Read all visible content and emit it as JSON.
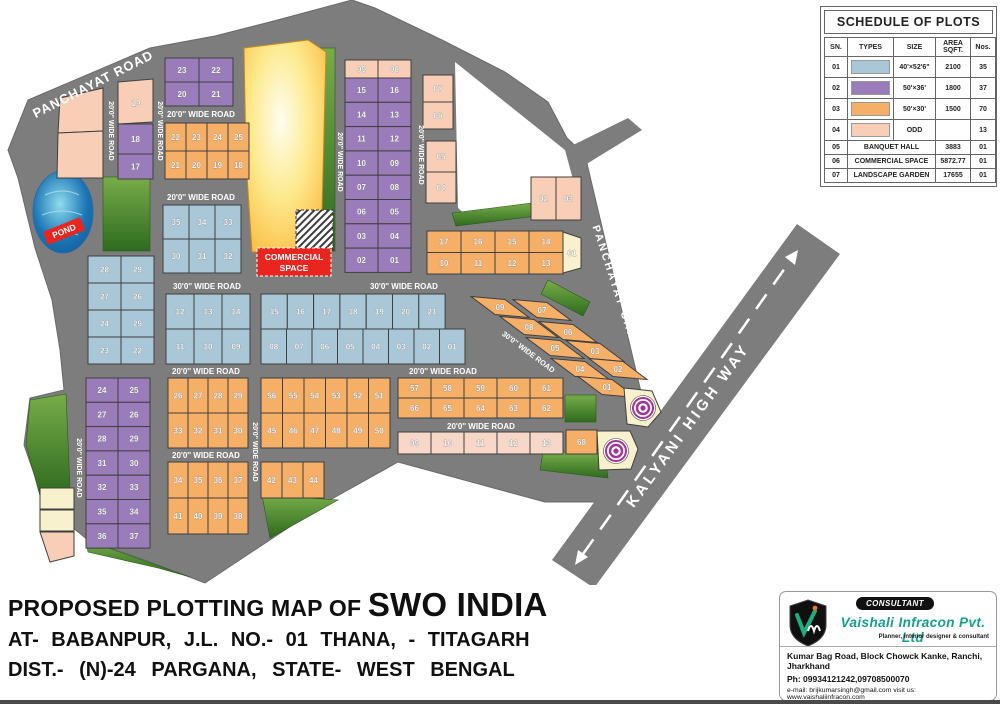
{
  "title_block": {
    "line1_prefix": "PROPOSED PLOTTING MAP OF",
    "line1_name": "SWO INDIA",
    "line2": "AT- BABANPUR, J.L. NO.- 01 THANA, - TITAGARH",
    "line3": "DIST.- (N)-24 PARGANA, STATE- WEST BENGAL"
  },
  "schedule": {
    "title": "SCHEDULE OF PLOTS",
    "headers": [
      "SN.",
      "TYPES",
      "SIZE",
      "AREA SQFT.",
      "Nos."
    ],
    "rows": [
      {
        "sn": "01",
        "color": "blue",
        "size": "40'×52'6\"",
        "area": "2100",
        "nos": "35"
      },
      {
        "sn": "02",
        "color": "purple",
        "size": "50'×36'",
        "area": "1800",
        "nos": "37"
      },
      {
        "sn": "03",
        "color": "orange",
        "size": "50'×30'",
        "area": "1500",
        "nos": "70"
      },
      {
        "sn": "04",
        "color": "peach",
        "size": "ODD",
        "area": "",
        "nos": "13"
      },
      {
        "sn": "05",
        "label": "BANQUET HALL",
        "area": "3883",
        "nos": "01"
      },
      {
        "sn": "06",
        "label": "COMMERCIAL SPACE",
        "area": "5872.77",
        "nos": "01"
      },
      {
        "sn": "07",
        "label": "LANDSCAPE GARDEN",
        "area": "17655",
        "nos": "01"
      }
    ]
  },
  "consultant": {
    "badge": "CONSULTANT",
    "company": "Vaishali Infracon Pvt. Ltd",
    "tagline": "Planner, interior designer & consultant",
    "address": "Kumar Bag Road, Block Chowck Kanke, Ranchi, Jharkhand",
    "phone": "Ph: 09934121242,09708500070",
    "email_web": "e-mail: brijkumarsingh@gmail.com visit us: www.vaishaliinfracon.com"
  },
  "map": {
    "pond_label": "POND",
    "commercial": {
      "line1": "COMMERCIAL",
      "line2": "SPACE"
    },
    "colors": {
      "blue": "#a9c7d6",
      "purple": "#9b7cba",
      "orange": "#f5af67",
      "peach": "#f8cfb6",
      "peachlight": "#f6d7c8",
      "cream": "#f7f2cd",
      "road": "#7d7d7d",
      "green": "#5d9038"
    },
    "road_labels": [
      {
        "text": "PANCHAYAT ROAD",
        "x": 95,
        "y": 88,
        "rot": -27,
        "size": 13,
        "ls": 1
      },
      {
        "text": "20'0'' WIDE ROAD",
        "x": 109,
        "y": 131,
        "rot": 90,
        "size": 7
      },
      {
        "text": "20'0'' WIDE ROAD",
        "x": 158,
        "y": 131,
        "rot": 90,
        "size": 7
      },
      {
        "text": "20'0'' WIDE ROAD",
        "x": 201,
        "y": 117,
        "size": 8
      },
      {
        "text": "20'0'' WIDE ROAD",
        "x": 201,
        "y": 200,
        "size": 8
      },
      {
        "text": "30'0'' WIDE ROAD",
        "x": 207,
        "y": 289,
        "size": 8
      },
      {
        "text": "30'0'' WIDE ROAD",
        "x": 404,
        "y": 289,
        "size": 8
      },
      {
        "text": "20'0'' WIDE ROAD",
        "x": 206,
        "y": 374,
        "size": 8
      },
      {
        "text": "20'0'' WIDE ROAD",
        "x": 443,
        "y": 374,
        "size": 8
      },
      {
        "text": "20'0'' WIDE ROAD",
        "x": 481,
        "y": 429,
        "size": 8
      },
      {
        "text": "20'0'' WIDE ROAD",
        "x": 206,
        "y": 458,
        "size": 8
      },
      {
        "text": "20'0'' WIDE ROAD",
        "x": 77,
        "y": 468,
        "rot": 90,
        "size": 7
      },
      {
        "text": "20'0'' WIDE ROAD",
        "x": 253,
        "y": 452,
        "rot": 90,
        "size": 7
      },
      {
        "text": "20'0'' WIDE ROAD",
        "x": 338,
        "y": 162,
        "rot": 90,
        "size": 7
      },
      {
        "text": "20'0'' WIDE ROAD",
        "x": 419,
        "y": 155,
        "rot": 90,
        "size": 7
      },
      {
        "text": "30'0'' WIDE ROAD",
        "x": 527,
        "y": 354,
        "rot": 37,
        "size": 7.5
      },
      {
        "text": "PANCHAYAT CANAL",
        "x": 614,
        "y": 293,
        "rot": 72,
        "size": 10.5,
        "ls": 2.5
      },
      {
        "text": "KALYANI HIGH WAY",
        "x": 692,
        "y": 428,
        "rot": -54,
        "size": 15,
        "ls": 3.5
      }
    ],
    "blocks": [
      {
        "x": 165,
        "y": 58,
        "cw": 34,
        "ch": 24,
        "color": "purple",
        "rows": [
          [
            "23",
            "22"
          ],
          [
            "20",
            "21"
          ]
        ]
      },
      {
        "x": 165,
        "y": 123,
        "cw": 21,
        "ch": 28,
        "color": "orange",
        "rows": [
          [
            "22",
            "23",
            "24",
            "25"
          ],
          [
            "21",
            "20",
            "19",
            "18"
          ]
        ]
      },
      {
        "x": 163,
        "y": 205,
        "cw": 26,
        "ch": 34,
        "color": "blue",
        "rows": [
          [
            "35",
            "34",
            "33"
          ],
          [
            "30",
            "31",
            "32"
          ]
        ]
      },
      {
        "x": 88,
        "y": 256,
        "cw": 33,
        "ch": 27,
        "color": "blue",
        "rows": [
          [
            "28",
            "29"
          ],
          [
            "27",
            "26"
          ],
          [
            "24",
            "25"
          ],
          [
            "23",
            "22"
          ]
        ]
      },
      {
        "x": 166,
        "y": 294,
        "cw": 28,
        "ch": 35,
        "color": "blue",
        "rows": [
          [
            "12",
            "13",
            "14"
          ],
          [
            "11",
            "10",
            "09"
          ]
        ]
      },
      {
        "x": 261,
        "y": 294,
        "cw": 26.3,
        "ch": 35,
        "color": "blue",
        "rows": [
          [
            "15",
            "16",
            "17",
            "18",
            "19",
            "20",
            "21"
          ]
        ]
      },
      {
        "x": 261,
        "y": 329,
        "cw": 25.5,
        "ch": 35,
        "color": "blue",
        "rows": [
          [
            "08",
            "07",
            "06",
            "05",
            "04",
            "03",
            "02",
            "01"
          ]
        ]
      },
      {
        "x": 345,
        "y": 60,
        "cw": 33,
        "ch": 18,
        "color": "peach",
        "rows": [
          [
            "09",
            "08"
          ]
        ]
      },
      {
        "x": 345,
        "y": 78,
        "cw": 33,
        "ch": 24.3,
        "color": "purple",
        "rows": [
          [
            "15",
            "16"
          ],
          [
            "14",
            "13"
          ],
          [
            "11",
            "12"
          ],
          [
            "10",
            "09"
          ],
          [
            "07",
            "08"
          ],
          [
            "06",
            "05"
          ],
          [
            "03",
            "04"
          ],
          [
            "02",
            "01"
          ]
        ]
      },
      {
        "x": 423,
        "y": 75,
        "cw": 30,
        "ch": 27,
        "color": "peach",
        "rows": [
          [
            "07"
          ],
          [
            "06"
          ]
        ]
      },
      {
        "x": 426,
        "y": 141,
        "cw": 30,
        "ch": 31,
        "color": "peach",
        "rows": [
          [
            "05"
          ],
          [
            "04"
          ]
        ]
      },
      {
        "x": 531,
        "y": 177,
        "cw": 25,
        "ch": 43,
        "color": "peach",
        "rows": [
          [
            "02",
            "03"
          ]
        ]
      },
      {
        "x": 427,
        "y": 231,
        "cw": 34,
        "ch": 21.5,
        "color": "orange",
        "rows": [
          [
            "17",
            "16",
            "15",
            "14"
          ],
          [
            "10",
            "11",
            "12",
            "13"
          ]
        ]
      },
      {
        "x": 168,
        "y": 378,
        "cw": 20,
        "ch": 35,
        "color": "orange",
        "rows": [
          [
            "26",
            "27",
            "28",
            "29"
          ],
          [
            "33",
            "32",
            "31",
            "30"
          ]
        ]
      },
      {
        "x": 261,
        "y": 378,
        "cw": 21.5,
        "ch": 35,
        "color": "orange",
        "rows": [
          [
            "56",
            "55",
            "54",
            "53",
            "52",
            "51"
          ],
          [
            "45",
            "46",
            "47",
            "48",
            "49",
            "50"
          ]
        ]
      },
      {
        "x": 168,
        "y": 462,
        "cw": 20,
        "ch": 36,
        "color": "orange",
        "rows": [
          [
            "34",
            "35",
            "36",
            "37"
          ],
          [
            "41",
            "40",
            "39",
            "38"
          ]
        ]
      },
      {
        "x": 261,
        "y": 462,
        "cw": 21,
        "ch": 36,
        "color": "orange",
        "rows": [
          [
            "42",
            "43",
            "44"
          ]
        ]
      },
      {
        "x": 86,
        "y": 378,
        "cw": 32,
        "ch": 24.3,
        "color": "purple",
        "rows": [
          [
            "24",
            "25"
          ],
          [
            "27",
            "26"
          ],
          [
            "28",
            "29"
          ],
          [
            "31",
            "30"
          ],
          [
            "32",
            "33"
          ],
          [
            "35",
            "34"
          ],
          [
            "36",
            "37"
          ]
        ]
      },
      {
        "x": 398,
        "y": 378,
        "cw": 33,
        "ch": 20,
        "color": "orange",
        "rows": [
          [
            "57",
            "58",
            "59",
            "60",
            "61"
          ],
          [
            "66",
            "65",
            "64",
            "63",
            "62"
          ]
        ]
      },
      {
        "x": 398,
        "y": 432,
        "cw": 33,
        "ch": 22,
        "color": "peachlight",
        "rows": [
          [
            "09",
            "10",
            "11",
            "12",
            "13"
          ]
        ]
      }
    ],
    "plots": [
      {
        "pts": "60,98 103,88 103,131 58,133",
        "color": "peach"
      },
      {
        "pts": "58,133 103,131 103,178 57,178",
        "color": "peach"
      },
      {
        "pts": "118,82 153,79 153,122 118,124",
        "color": "peach",
        "label": "19",
        "lx": 136,
        "ly": 106
      },
      {
        "x": 118,
        "y": 124,
        "w": 35,
        "h": 30,
        "color": "purple",
        "label": "18"
      },
      {
        "x": 118,
        "y": 154,
        "w": 35,
        "h": 25,
        "color": "purple",
        "label": "17"
      },
      {
        "pts": "563,232 581,238 581,268 563,273",
        "color": "cream",
        "label": "01",
        "lx": 572,
        "ly": 256
      },
      {
        "cx": 500,
        "cy": 307,
        "color": "orange",
        "label": "09"
      },
      {
        "cx": 542,
        "cy": 310,
        "color": "orange",
        "label": "07"
      },
      {
        "cx": 529,
        "cy": 327,
        "color": "orange",
        "label": "08"
      },
      {
        "cx": 568,
        "cy": 332,
        "color": "orange",
        "label": "06"
      },
      {
        "cx": 555,
        "cy": 348,
        "color": "orange",
        "label": "05"
      },
      {
        "cx": 595,
        "cy": 351,
        "color": "orange",
        "label": "03"
      },
      {
        "cx": 580,
        "cy": 369,
        "color": "orange",
        "label": "04"
      },
      {
        "cx": 618,
        "cy": 369,
        "color": "orange",
        "label": "02"
      },
      {
        "cx": 607,
        "cy": 387,
        "color": "orange",
        "label": "01"
      },
      {
        "pts": "624,388 652,391 661,412 648,427 627,424",
        "color": "cream"
      },
      {
        "pts": "597,431 630,431 638,449 631,469 599,470",
        "color": "cream"
      },
      {
        "x": 566,
        "y": 430,
        "w": 31,
        "h": 24,
        "color": "orange",
        "label": "68"
      },
      {
        "x": 40,
        "y": 488,
        "w": 34,
        "h": 21,
        "color": "cream"
      },
      {
        "x": 40,
        "y": 510,
        "w": 34,
        "h": 21,
        "color": "cream"
      },
      {
        "pts": "40,532 74,532 74,556 50,562",
        "color": "peach"
      }
    ]
  }
}
